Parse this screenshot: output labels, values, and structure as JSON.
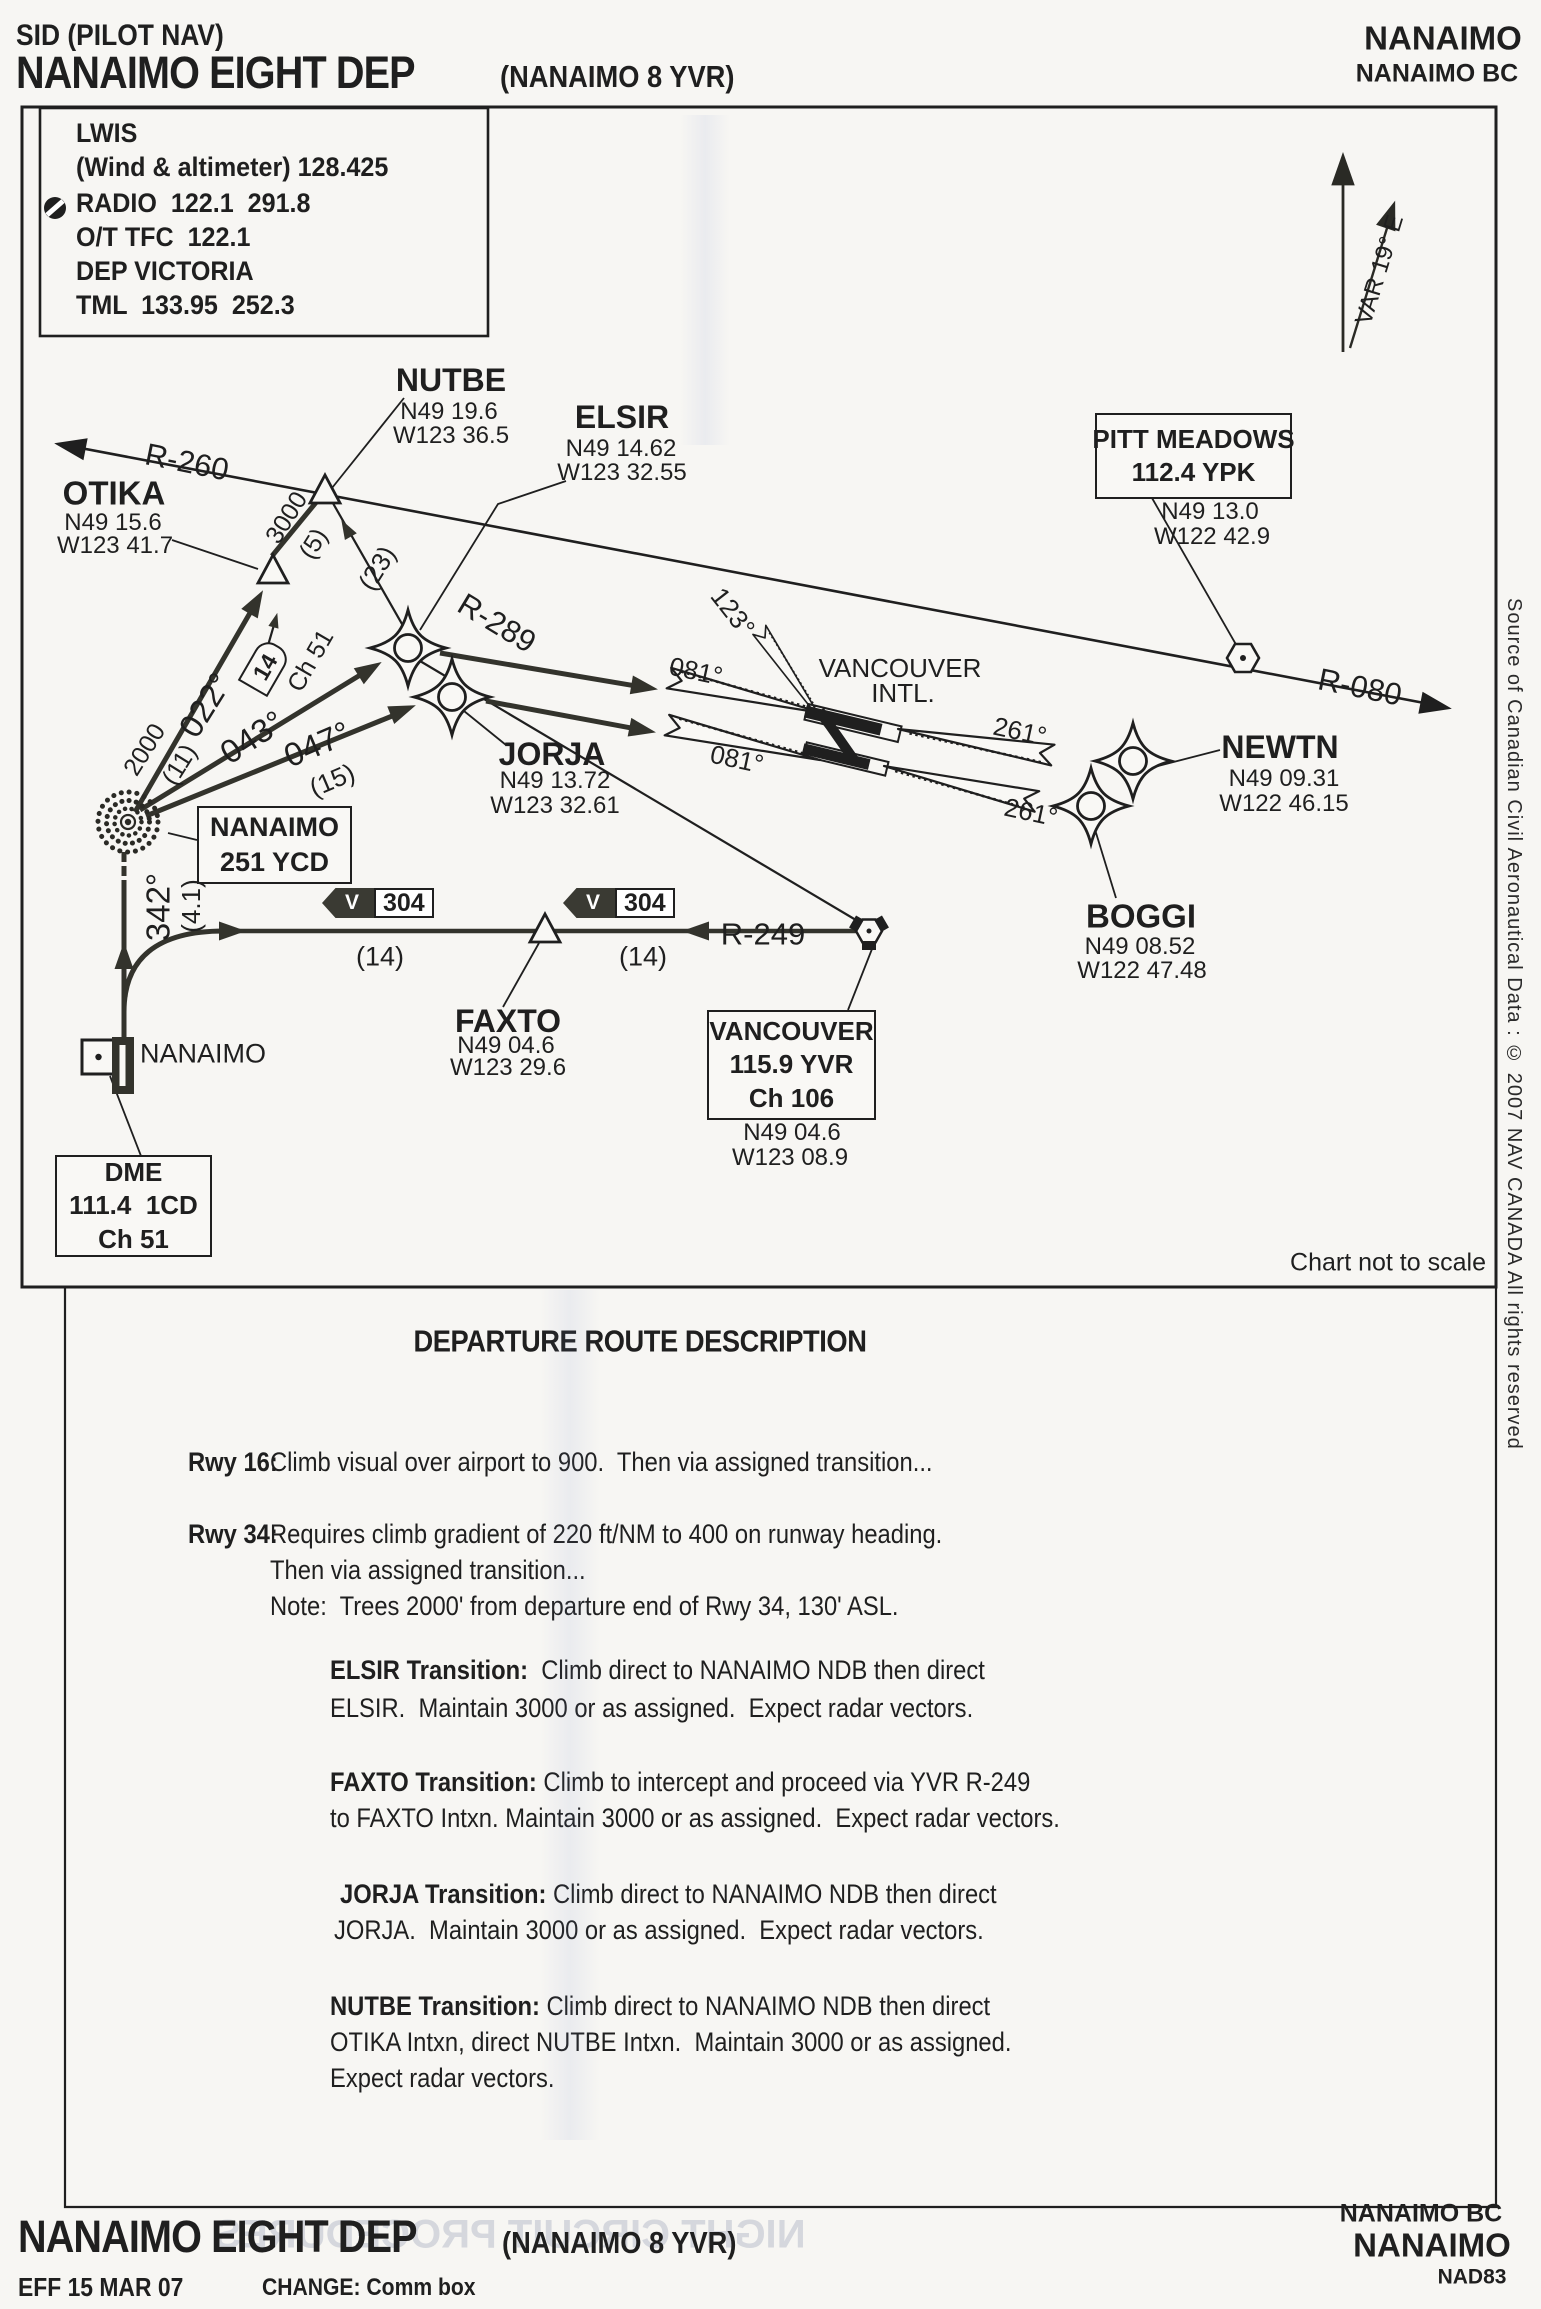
{
  "colors": {
    "ink": "#1f1f1f",
    "route_dark": "#3a3a33",
    "paper": "#f7f6f3"
  },
  "header": {
    "doc_type": "SID (PILOT NAV)",
    "title": "NANAIMO EIGHT DEP",
    "title_suffix": "(NANAIMO 8 YVR)",
    "right_line1": "NANAIMO",
    "right_line2": "NANAIMO BC"
  },
  "comm_box": {
    "lines": [
      "LWIS",
      "(Wind & altimeter) 128.425",
      "RADIO  122.1  291.8",
      "O/T TFC  122.1",
      "DEP VICTORIA",
      "TML  133.95  252.3"
    ]
  },
  "north_arrow": {
    "variation": "VAR 19° E"
  },
  "fixes": {
    "nutbe": {
      "name": "NUTBE",
      "lat": "N49 19.6",
      "lon": "W123 36.5"
    },
    "otika": {
      "name": "OTIKA",
      "lat": "N49 15.6",
      "lon": "W123 41.7"
    },
    "elsir": {
      "name": "ELSIR",
      "lat": "N49 14.62",
      "lon": "W123 32.55"
    },
    "jorja": {
      "name": "JORJA",
      "lat": "N49 13.72",
      "lon": "W123 32.61"
    },
    "newtn": {
      "name": "NEWTN",
      "lat": "N49 09.31",
      "lon": "W122 46.15"
    },
    "boggi": {
      "name": "BOGGI",
      "lat": "N49 08.52",
      "lon": "W122 47.48"
    },
    "faxto": {
      "name": "FAXTO",
      "lat": "N49 04.6",
      "lon": "W123 29.6"
    }
  },
  "navaids": {
    "pitt_meadows": {
      "name": "PITT MEADOWS",
      "freq": "112.4 YPK",
      "lat": "N49 13.0",
      "lon": "W122 42.9"
    },
    "vancouver": {
      "name": "VANCOUVER",
      "freq": "115.9 YVR",
      "channel": "Ch 106",
      "lat": "N49 04.6",
      "lon": "W123 08.9"
    },
    "nanaimo_ndb": {
      "name": "NANAIMO",
      "freq": "251 YCD"
    },
    "nanaimo_dme": {
      "name": "DME",
      "freq": "111.4  1CD",
      "channel": "Ch 51"
    }
  },
  "airport": {
    "label": "NANAIMO",
    "intl_line1": "VANCOUVER",
    "intl_line2": "INTL."
  },
  "radials": {
    "r260": "R-260",
    "r289": "R-289",
    "r080": "R-080",
    "r249": "R-249"
  },
  "tracks": {
    "t022": "022°",
    "t043": "043°",
    "t047": "047°",
    "t342": "342°",
    "t123": "123°",
    "t081": "081°",
    "t261": "261°"
  },
  "annotations": {
    "alt2000": "2000",
    "d11": "(11)",
    "alt3000": "3000",
    "d5": "(5)",
    "d23": "(23)",
    "d15": "(15)",
    "d41": "(4.1)",
    "d14": "(14)",
    "dme_dist": "14",
    "ch51": "Ch 51",
    "v": "V",
    "airway": "304",
    "not_to_scale": "Chart not to scale"
  },
  "sidebar": {
    "copyright": "Source of Canadian Civil Aeronautical Data : © 2007 NAV CANADA All rights reserved"
  },
  "description": {
    "heading": "DEPARTURE ROUTE DESCRIPTION",
    "rwy16_label": "Rwy 16:",
    "rwy16_text": "Climb visual over airport to 900.  Then via assigned transition...",
    "rwy34_label": "Rwy 34:",
    "rwy34_line1": "Requires climb gradient of 220 ft/NM to 400 on runway heading.",
    "rwy34_line2": "Then via assigned transition...",
    "rwy34_line3": "Note:  Trees 2000' from departure end of Rwy 34, 130' ASL.",
    "elsir_label": "ELSIR Transition:",
    "elsir_line1": "  Climb direct to NANAIMO NDB then direct",
    "elsir_line2": "ELSIR.  Maintain 3000 or as assigned.  Expect radar vectors.",
    "faxto_label": "FAXTO Transition:",
    "faxto_line1": " Climb to intercept and proceed via YVR R-249",
    "faxto_line2": "to FAXTO Intxn. Maintain 3000 or as assigned.  Expect radar vectors.",
    "jorja_label": "JORJA Transition:",
    "jorja_line1": " Climb direct to NANAIMO NDB then direct",
    "jorja_line2": "JORJA.  Maintain 3000 or as assigned.  Expect radar vectors.",
    "nutbe_label": "NUTBE Transition:",
    "nutbe_line1": " Climb direct to NANAIMO NDB then direct",
    "nutbe_line2": "OTIKA Intxn, direct NUTBE Intxn.  Maintain 3000 or as assigned.",
    "nutbe_line3": "Expect radar vectors."
  },
  "footer": {
    "title": "NANAIMO EIGHT DEP",
    "title_suffix": "(NANAIMO 8 YVR)",
    "effective": "EFF 15 MAR 07",
    "change": "CHANGE: Comm box",
    "right_line1": "NANAIMO BC",
    "right_line2": "NANAIMO",
    "right_line3": "NAD83",
    "bleed_through": "NIGHT CIRCUIT PROCEDURES"
  }
}
